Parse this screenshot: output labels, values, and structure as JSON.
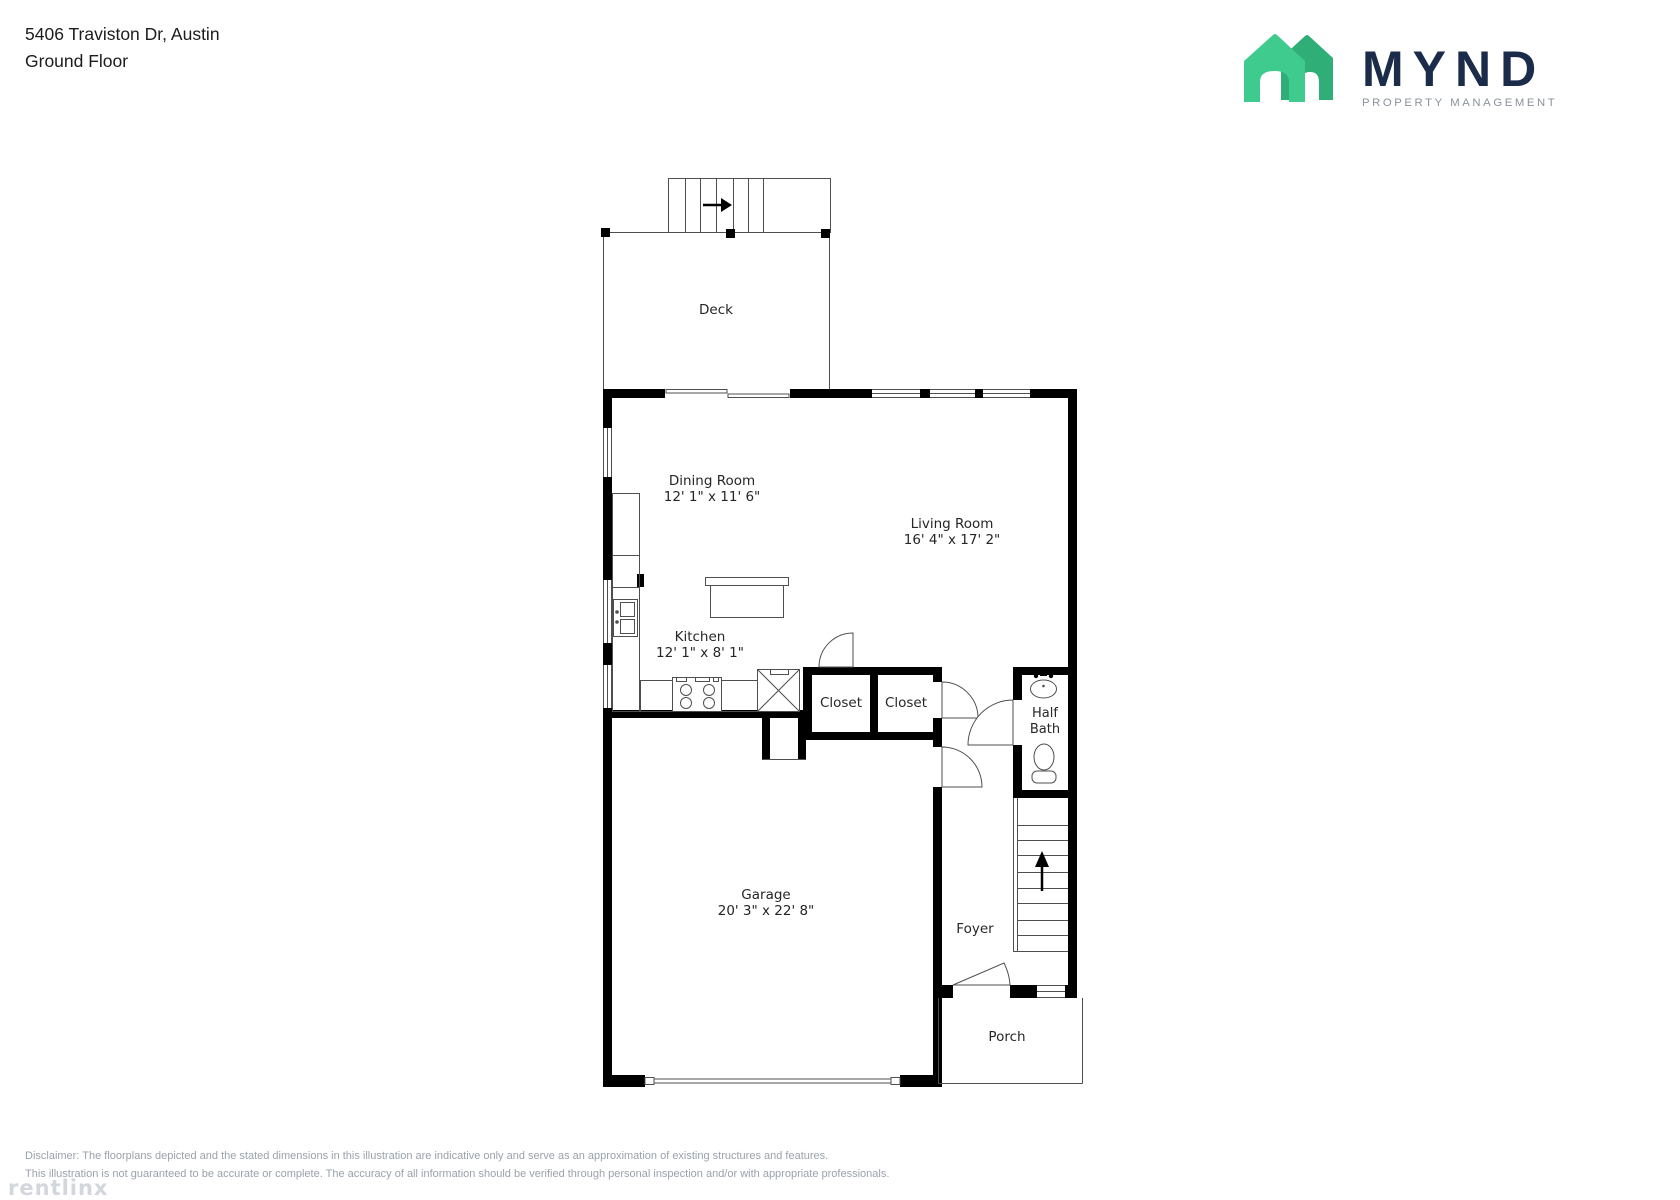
{
  "header": {
    "address_line": "5406 Traviston Dr, Austin",
    "floor_line": "Ground Floor"
  },
  "brand": {
    "wordmark": "MYND",
    "tagline": "PROPERTY MANAGEMENT",
    "colors": {
      "house_front": "#3ECB8D",
      "house_back": "#2FAE77",
      "wordmark_text": "#1B2B4A",
      "tagline_text": "#8B929C"
    }
  },
  "floorplan": {
    "wall_color": "#000000",
    "line_color": "#4f4f4f",
    "rooms": [
      {
        "name": "Deck",
        "dims": ""
      },
      {
        "name": "Dining Room",
        "dims": "12' 1\" x 11' 6\""
      },
      {
        "name": "Living Room",
        "dims": "16' 4\" x 17' 2\""
      },
      {
        "name": "Kitchen",
        "dims": "12' 1\" x 8' 1\""
      },
      {
        "name": "Closet",
        "dims": ""
      },
      {
        "name": "Closet",
        "dims": ""
      },
      {
        "name": "Half Bath",
        "dims": ""
      },
      {
        "name": "Garage",
        "dims": "20' 3\" x 22' 8\""
      },
      {
        "name": "Foyer",
        "dims": ""
      },
      {
        "name": "Porch",
        "dims": ""
      }
    ]
  },
  "footer": {
    "disclaimer_line1": "Disclaimer: The floorplans depicted and the stated dimensions in this illustration are indicative only and serve as an approximation of existing structures and features.",
    "disclaimer_line2": "This illustration is not guaranteed to be accurate or complete. The accuracy of all information should be verified through personal inspection and/or with appropriate professionals.",
    "watermark": "rentlinx"
  }
}
